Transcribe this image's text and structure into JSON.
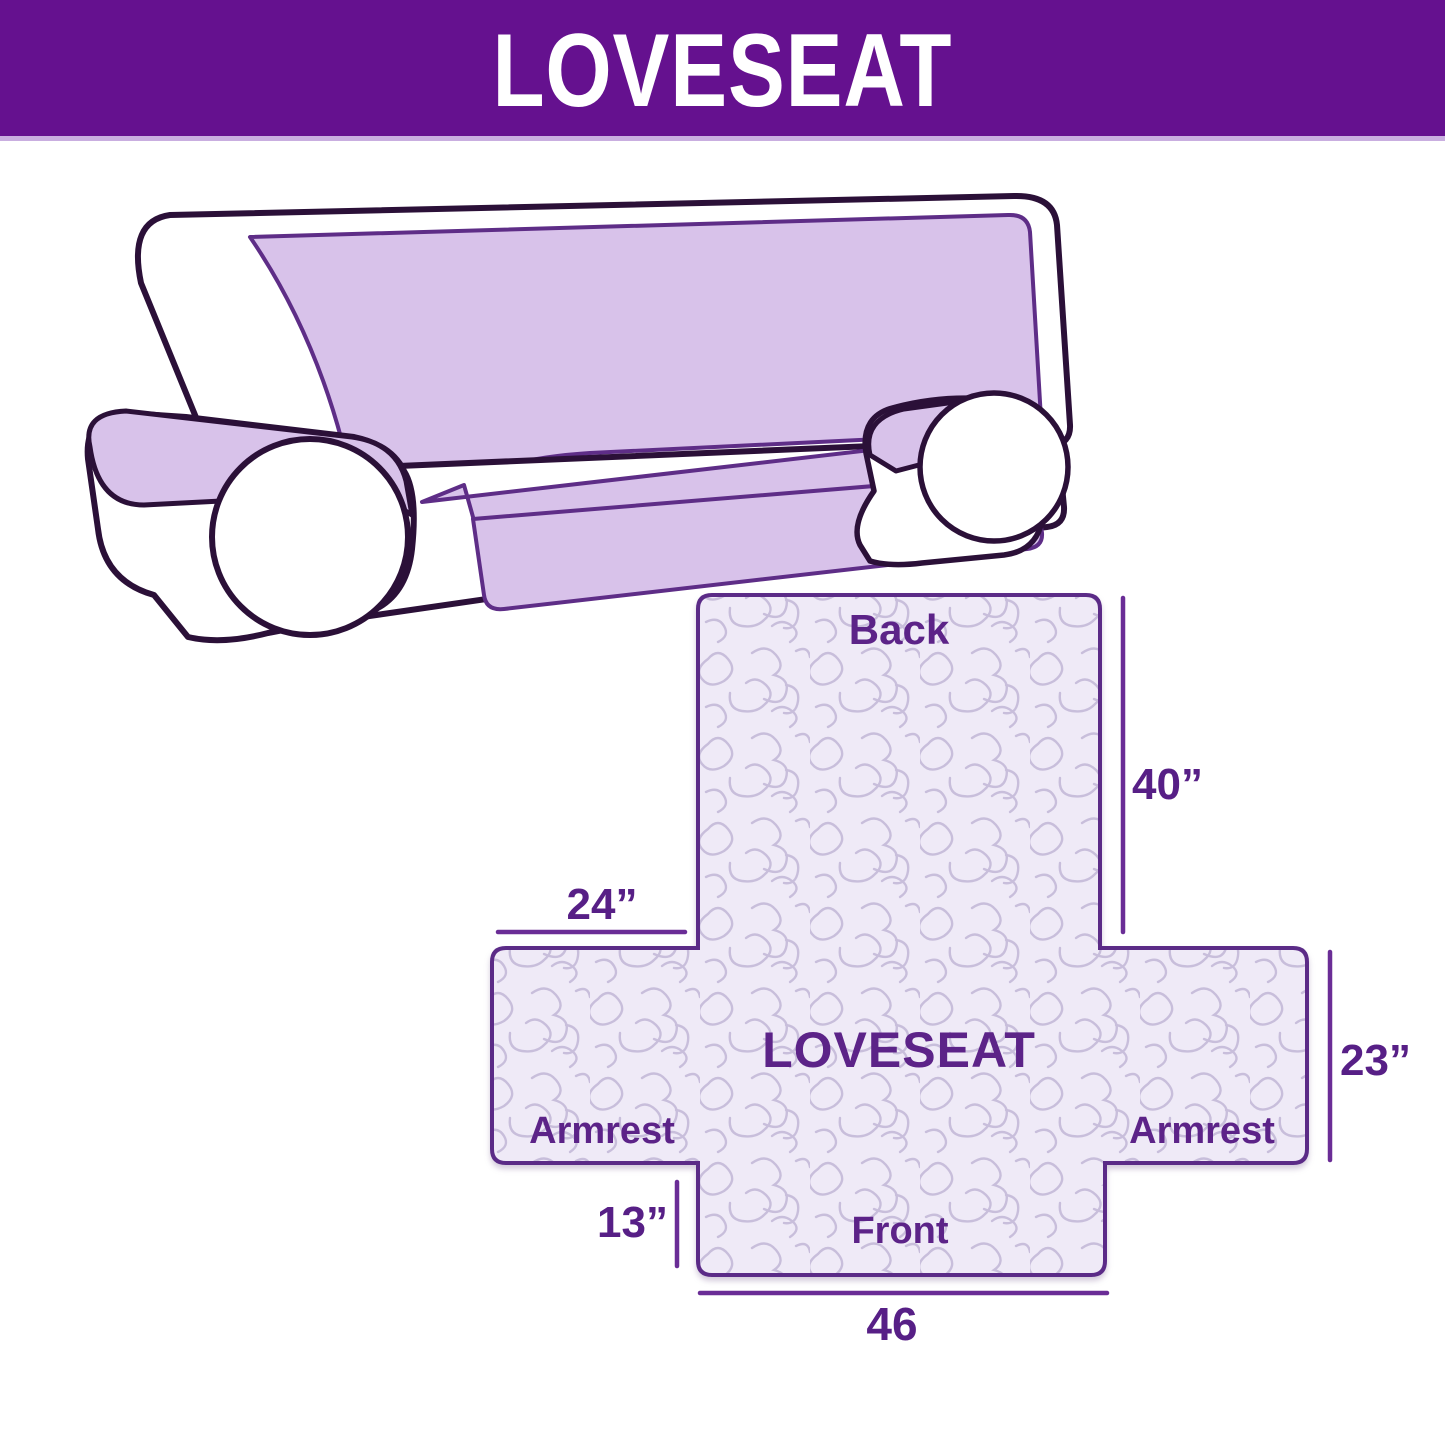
{
  "header": {
    "title": "LOVESEAT"
  },
  "illustration": {
    "description": "two-seat sofa with lavender slipcover on back, armrest tops, seat and front skirt"
  },
  "diagram": {
    "labels": {
      "back": "Back",
      "center": "LOVESEAT",
      "armrest_left": "Armrest",
      "armrest_right": "Armrest",
      "front": "Front"
    },
    "dimensions": {
      "back_height": "40”",
      "armrest_top_width": "24”",
      "side_height": "23”",
      "front_flap_height": "13”",
      "front_width": "46"
    }
  },
  "colors": {
    "header_bg": "#65118f",
    "header_text": "#ffffff",
    "header_underline": "#c9aee0",
    "label_text": "#5c2388",
    "dimension_line": "#6a2d96",
    "cover_outline": "#5b2b87",
    "panel_fill": "#efeaf7",
    "quilt_pattern_line": "#c8bedb",
    "sofa_outline": "#2b1038",
    "sofa_cover_fill": "#d8c2ea",
    "sofa_cover_stroke": "#5e2d87"
  }
}
